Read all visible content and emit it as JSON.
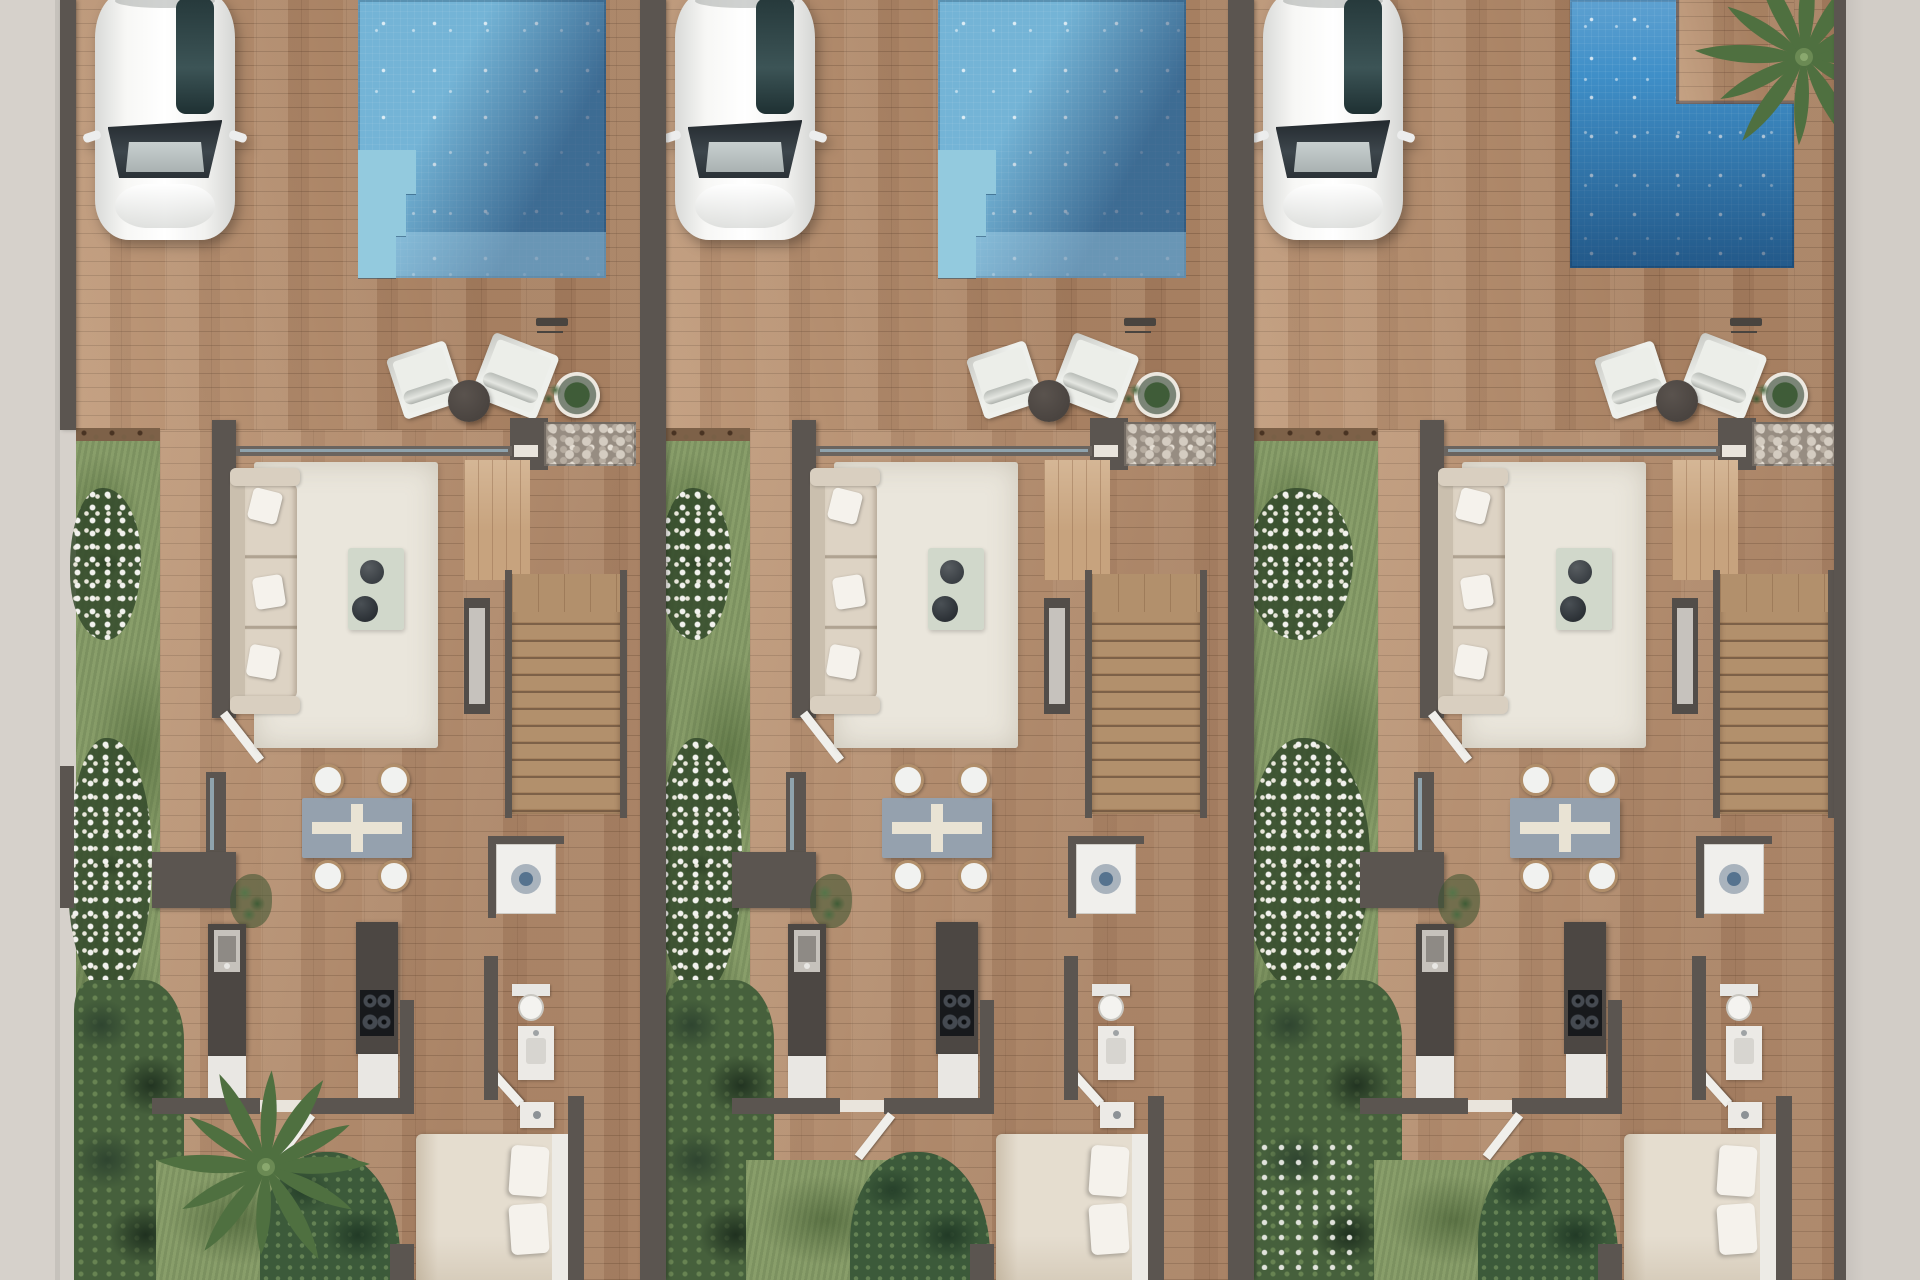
{
  "scene": {
    "description": "Aerial top-down 3D architectural render of three attached villas, each with a private driveway with parked white car, swimming pool, furnished terrace, living-dining room, kitchen, staircase, bathroom, double bedroom and a lawned side garden with flowering shrubs. No text is visible in the image.",
    "view": "top-down floor plan render",
    "units_count": 3
  },
  "colors": {
    "sidewalk": "#d6d1cb",
    "sidewalk_right": "#d2cdc7",
    "wall": "#5b5550",
    "wall_dark": "#49443f",
    "paving": "#b28a6a",
    "floor": "#b48d6e",
    "entry_floor": "#c7a37e",
    "grass": "#869b68",
    "grass_dark": "#5c7745",
    "soil": "#7d6148",
    "bush": "#46603c",
    "bush_dark": "#2f4530",
    "pool_base": "#74b4d6",
    "pool_deep": "#2e5f94",
    "pool_step": "#93cade",
    "pool3_base": "#3f8fc8",
    "pool3_deep": "#1f5693",
    "pool3_light": "#6cb4e0",
    "rug": "#eae6dc",
    "sofa": "#d9cfc0",
    "sofa_cushion": "#ddd3c4",
    "pillow": "#f5f2ec",
    "chair_white": "#eceee9",
    "table_dark": "#4a4440",
    "dining_table": "#95a1ae",
    "dining_cross": "#e9e3d4",
    "wood_stairs": "#b2906c",
    "stair_line": "#7d6148",
    "counter_dark": "#4c4743",
    "cabinet_white": "#e9e7e3",
    "cooktop": "#17191c",
    "bed_duvet": "#e5ddcf",
    "glass": "#8fa3ad",
    "flower_white": "#f2f2ee",
    "palm": "#55754a",
    "palm_dark": "#3f5c36",
    "palm_light": "#6e905a"
  },
  "units": [
    {
      "id": "unit-1",
      "label": "left villa",
      "left_px": 60,
      "width_px": 580,
      "wall_left_px": 16,
      "garden_width_px": 84,
      "interior_shift_px": 0,
      "pool_type": "rectangular",
      "pool_features": [
        "corner entry steps",
        "shallow ledge",
        "deep end shaded top-right"
      ],
      "has_bottom_palm": true,
      "has_pool_palm": false,
      "extra_bush_flowers": false,
      "car_parked": true
    },
    {
      "id": "unit-2",
      "label": "middle villa",
      "left_px": 640,
      "width_px": 588,
      "wall_left_px": 26,
      "garden_width_px": 84,
      "interior_shift_px": 0,
      "pool_type": "rectangular",
      "pool_features": [
        "corner entry steps",
        "shallow ledge",
        "deep end shaded top-right"
      ],
      "has_bottom_palm": false,
      "has_pool_palm": false,
      "extra_bush_flowers": false,
      "car_parked": true
    },
    {
      "id": "unit-3",
      "label": "right villa (end unit)",
      "left_px": 1228,
      "width_px": 606,
      "wall_left_px": 26,
      "garden_width_px": 124,
      "interior_shift_px": 40,
      "pool_type": "l-shaped",
      "pool_features": [
        "palm tree planter notch at top-right",
        "deep shaded bottom"
      ],
      "has_bottom_palm": false,
      "has_pool_palm": true,
      "extra_bush_flowers": true,
      "car_parked": true
    }
  ],
  "rooms_per_unit": [
    "driveway with parked white car",
    "swimming pool",
    "terrace with two white lounge chairs, round side table, plant pot and pebble planter",
    "living room with cream sofa, area rug and coffee tray with two dark bowls",
    "wooden staircase",
    "dining area with square table and four chairs",
    "kitchen with sink counter, island hob and white cabinets",
    "utility room with washing machine",
    "bathroom with toilet and washbasin",
    "double bedroom with bed and side tables",
    "side garden with lawn, white flower clusters and dense shrubs"
  ]
}
